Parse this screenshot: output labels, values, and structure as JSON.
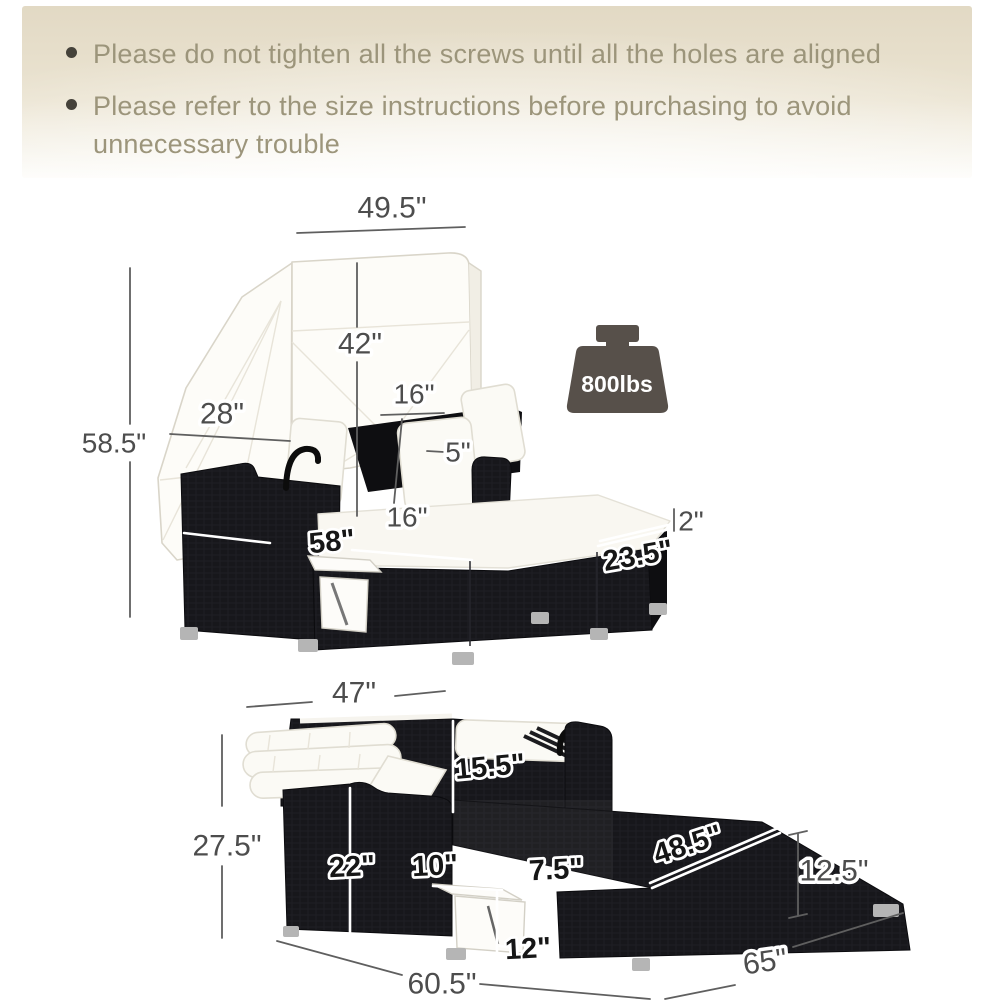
{
  "header": {
    "bullets": [
      "Please do not tighten all the screws until all the holes are aligned",
      "Please refer to the size instructions before purchasing to avoid unnecessary trouble"
    ]
  },
  "weight_capacity": {
    "label": "800lbs"
  },
  "diagram_top": {
    "dims": {
      "canopy_width": "49.5\"",
      "canopy_height": "42\"",
      "pillow_width": "16\"",
      "canopy_depth": "28\"",
      "overall_height": "58.5\"",
      "pillow_thickness": "5\"",
      "backrest_seat_width": "16\"",
      "cushion_thickness": "2\"",
      "bed_length": "58\"",
      "bed_depth": "23.5\""
    }
  },
  "diagram_bottom": {
    "dims": {
      "top_width": "47\"",
      "overall_height": "27.5\"",
      "backrest_height": "15.5\"",
      "seat_height": "22\"",
      "table_width": "10\"",
      "platform_step": "7.5\"",
      "table_drop": "12\"",
      "bed_top_width": "48.5\"",
      "base_height": "12.5\"",
      "base_length": "60.5\"",
      "base_depth": "65\""
    }
  }
}
